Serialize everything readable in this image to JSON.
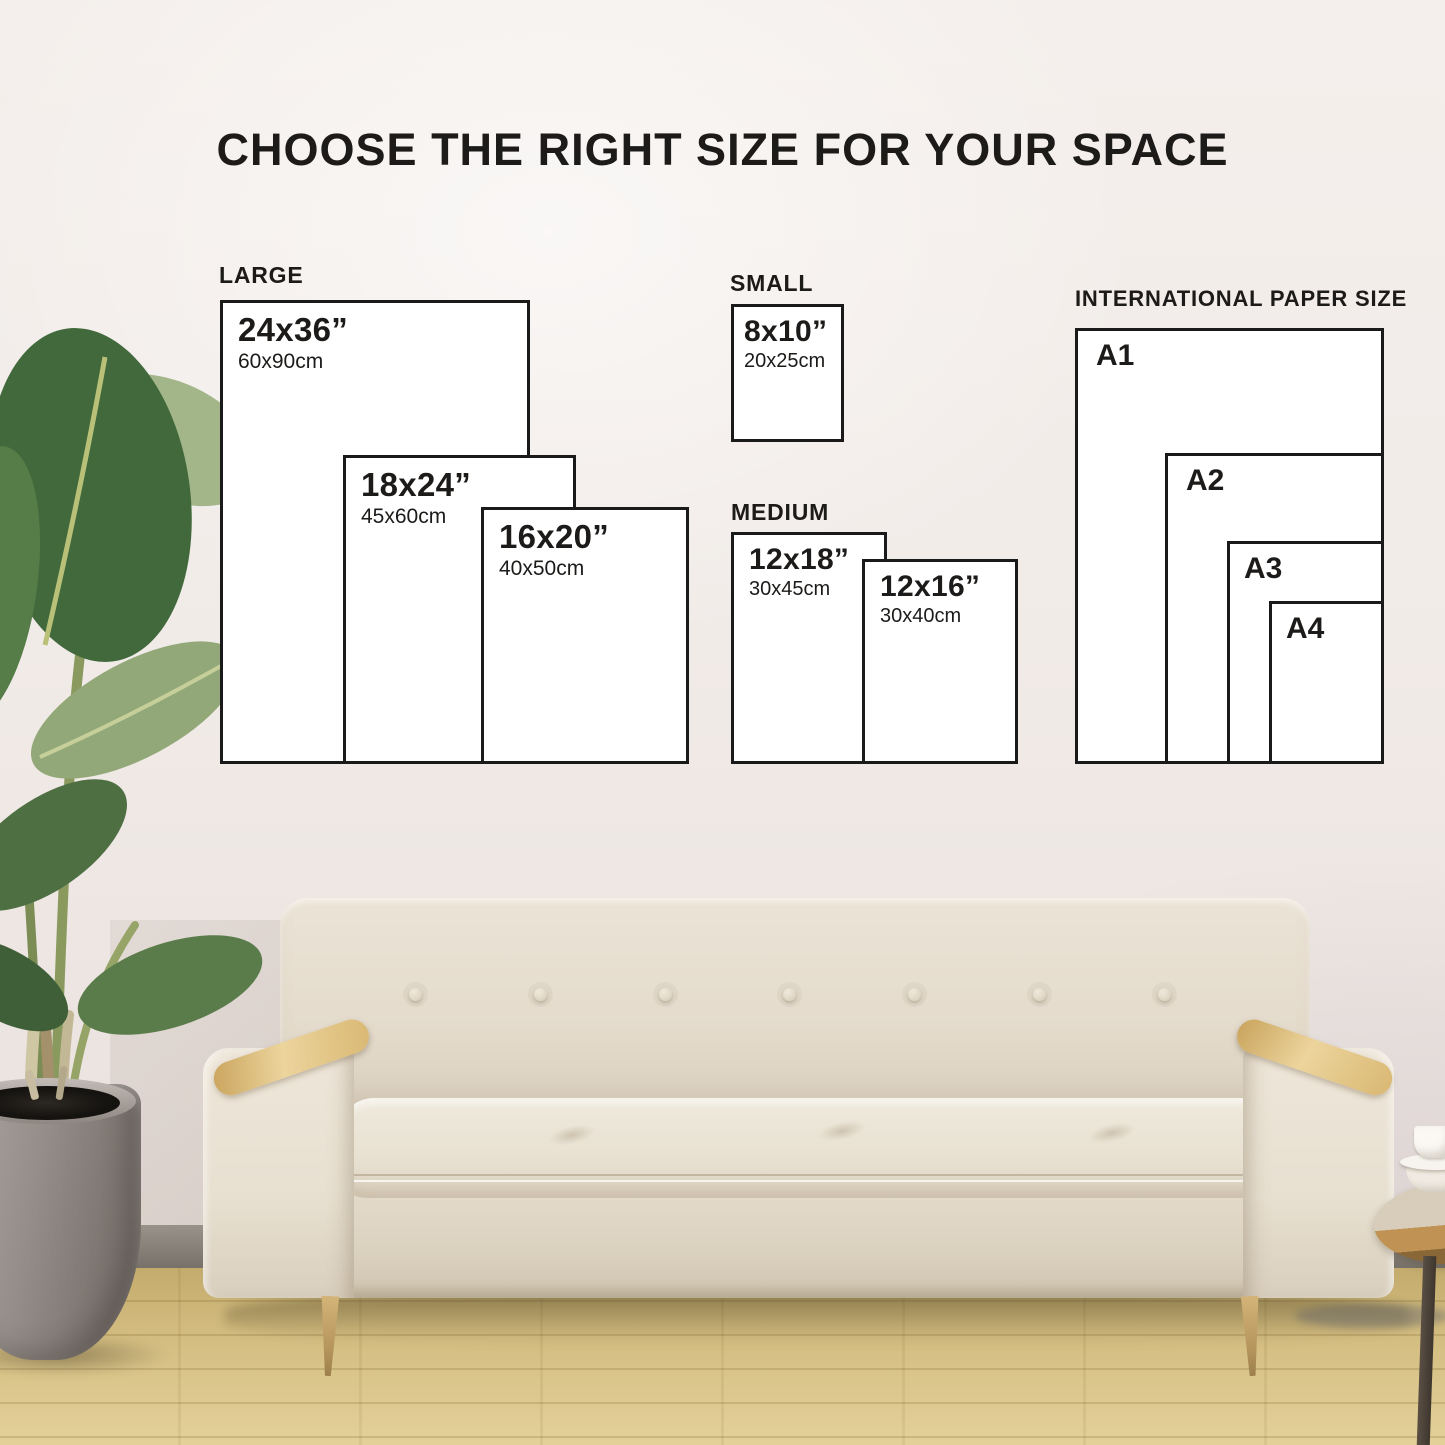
{
  "title": "CHOOSE THE RIGHT SIZE FOR YOUR SPACE",
  "sections": {
    "large": {
      "label": "LARGE",
      "boxes": [
        {
          "inches": "24x36”",
          "cm": "60x90cm"
        },
        {
          "inches": "18x24”",
          "cm": "45x60cm"
        },
        {
          "inches": "16x20”",
          "cm": "40x50cm"
        }
      ]
    },
    "small": {
      "label": "SMALL",
      "boxes": [
        {
          "inches": "8x10”",
          "cm": "20x25cm"
        }
      ]
    },
    "medium": {
      "label": "MEDIUM",
      "boxes": [
        {
          "inches": "12x18”",
          "cm": "30x45cm"
        },
        {
          "inches": "12x16”",
          "cm": "30x40cm"
        }
      ]
    },
    "international": {
      "label": "INTERNATIONAL PAPER SIZE",
      "boxes": [
        {
          "name": "A1"
        },
        {
          "name": "A2"
        },
        {
          "name": "A3"
        },
        {
          "name": "A4"
        }
      ]
    }
  },
  "colors": {
    "box-border": "#1a1a1a",
    "box-fill": "#ffffff",
    "diagram-text": "#1d1b19"
  }
}
